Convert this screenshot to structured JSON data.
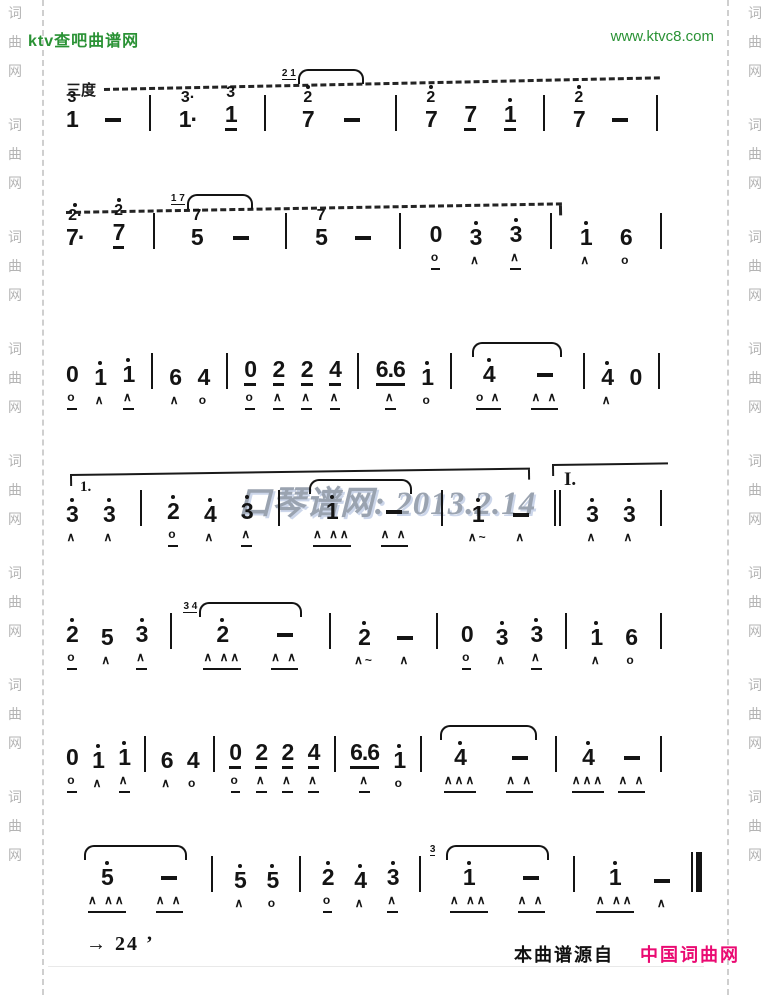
{
  "header": {
    "site": "ktv查吧曲谱网",
    "url": "www.ktvc8.com",
    "green": "#2a9235"
  },
  "margins": {
    "text": "词曲网"
  },
  "score": {
    "interval_label": "三度",
    "volta_left": "1.",
    "volta_right": "I.",
    "watermark": "口琴谱网: 2013.2.14",
    "ink": "#141414",
    "systems": [
      {
        "tokens": [
          {
            "k": "n",
            "t": "1",
            "top": "3"
          },
          {
            "k": "d"
          },
          {
            "k": "b"
          },
          {
            "k": "n",
            "t": "1",
            "top": "3",
            "dt": true
          },
          {
            "k": "n",
            "t": "1",
            "top": "3",
            "ul": 1
          },
          {
            "k": "b"
          },
          {
            "k": "tie",
            "items": [
              {
                "k": "n",
                "t": "7",
                "top": "2",
                "toph": 1,
                "gr": "2 1"
              },
              {
                "k": "d"
              }
            ]
          },
          {
            "k": "b"
          },
          {
            "k": "n",
            "t": "7",
            "top": "2",
            "toph": 1
          },
          {
            "k": "n",
            "t": "7",
            "ul": 1
          },
          {
            "k": "n",
            "t": "1",
            "hd": 1,
            "ul": 1
          },
          {
            "k": "b"
          },
          {
            "k": "n",
            "t": "7",
            "top": "2",
            "toph": 1
          },
          {
            "k": "d"
          },
          {
            "k": "b"
          }
        ]
      },
      {
        "tokens": [
          {
            "k": "n",
            "t": "7",
            "top": "2",
            "toph": 1,
            "dt": true
          },
          {
            "k": "n",
            "t": "7",
            "top": "2",
            "toph": 1,
            "ul": 1
          },
          {
            "k": "b"
          },
          {
            "k": "tie",
            "items": [
              {
                "k": "n",
                "t": "5",
                "top": "7",
                "gr": "1 7"
              },
              {
                "k": "d"
              }
            ]
          },
          {
            "k": "b"
          },
          {
            "k": "n",
            "t": "5",
            "top": "7"
          },
          {
            "k": "d"
          },
          {
            "k": "b"
          },
          {
            "k": "n",
            "t": "0",
            "u": "o",
            "uml": true
          },
          {
            "k": "n",
            "t": "3",
            "hd": 1,
            "u": "∧"
          },
          {
            "k": "n",
            "t": "3",
            "hd": 1,
            "u": "∧",
            "uml": true
          },
          {
            "k": "b"
          },
          {
            "k": "n",
            "t": "1",
            "hd": 1,
            "u": "∧"
          },
          {
            "k": "n",
            "t": "6",
            "u": "o"
          },
          {
            "k": "b"
          }
        ]
      },
      {
        "tokens": [
          {
            "k": "n",
            "t": "0",
            "u": "o",
            "uml": true
          },
          {
            "k": "n",
            "t": "1",
            "hd": 1,
            "u": "∧"
          },
          {
            "k": "n",
            "t": "1",
            "hd": 1,
            "u": "∧",
            "uml": true
          },
          {
            "k": "b"
          },
          {
            "k": "n",
            "t": "6",
            "u": "∧"
          },
          {
            "k": "n",
            "t": "4",
            "u": "o"
          },
          {
            "k": "b"
          },
          {
            "k": "n",
            "t": "0",
            "ul": 1,
            "u": "o",
            "uml": true
          },
          {
            "k": "n",
            "t": "2",
            "ul": 1,
            "u": "∧",
            "uml": true
          },
          {
            "k": "n",
            "t": "2",
            "ul": 1,
            "u": "∧",
            "uml": true
          },
          {
            "k": "n",
            "t": "4",
            "ul": 1,
            "u": "∧",
            "uml": true
          },
          {
            "k": "b"
          },
          {
            "k": "n",
            "t": "6.6",
            "ul": 1,
            "u": "∧",
            "uml": true
          },
          {
            "k": "n",
            "t": "1",
            "hd": 1,
            "u": "o"
          },
          {
            "k": "b"
          },
          {
            "k": "tie",
            "items": [
              {
                "k": "n",
                "t": "4",
                "hd": 1,
                "u": "o ∧",
                "uml": true
              },
              {
                "k": "d",
                "u": "∧ ∧",
                "uml": true
              }
            ]
          },
          {
            "k": "b"
          },
          {
            "k": "n",
            "t": "4",
            "hd": 1,
            "u": "∧"
          },
          {
            "k": "n",
            "t": "0"
          },
          {
            "k": "b"
          }
        ]
      },
      {
        "tokens": [
          {
            "k": "n",
            "t": "3",
            "hd": 1,
            "u": "∧"
          },
          {
            "k": "n",
            "t": "3",
            "hd": 1,
            "u": "∧"
          },
          {
            "k": "b"
          },
          {
            "k": "n",
            "t": "2",
            "hd": 1,
            "u": "o",
            "uml": true
          },
          {
            "k": "n",
            "t": "4",
            "hd": 1,
            "u": "∧"
          },
          {
            "k": "n",
            "t": "3",
            "hd": 1,
            "u": "∧",
            "uml": true
          },
          {
            "k": "b"
          },
          {
            "k": "tie",
            "items": [
              {
                "k": "n",
                "t": "1",
                "hd": 1,
                "u": "∧ ∧∧",
                "uml": true
              },
              {
                "k": "d",
                "u": "∧ ∧",
                "uml": true
              }
            ]
          },
          {
            "k": "b"
          },
          {
            "k": "n",
            "t": "1",
            "hd": 1,
            "u": "∧~"
          },
          {
            "k": "d",
            "u": "∧"
          },
          {
            "k": "b2"
          },
          {
            "k": "n",
            "t": "3",
            "hd": 1,
            "u": "∧"
          },
          {
            "k": "n",
            "t": "3",
            "hd": 1,
            "u": "∧"
          },
          {
            "k": "b"
          }
        ]
      },
      {
        "tokens": [
          {
            "k": "n",
            "t": "2",
            "hd": 1,
            "u": "o",
            "uml": true
          },
          {
            "k": "n",
            "t": "5",
            "u": "∧"
          },
          {
            "k": "n",
            "t": "3",
            "hd": 1,
            "u": "∧",
            "uml": true
          },
          {
            "k": "b"
          },
          {
            "k": "tie",
            "items": [
              {
                "k": "n",
                "t": "2",
                "hd": 1,
                "gr": "3 4",
                "u": "∧ ∧∧",
                "uml": true
              },
              {
                "k": "d",
                "u": "∧ ∧",
                "uml": true
              }
            ]
          },
          {
            "k": "b"
          },
          {
            "k": "n",
            "t": "2",
            "hd": 1,
            "u": "∧~"
          },
          {
            "k": "d",
            "u": "∧"
          },
          {
            "k": "b"
          },
          {
            "k": "n",
            "t": "0",
            "u": "o",
            "uml": true
          },
          {
            "k": "n",
            "t": "3",
            "hd": 1,
            "u": "∧"
          },
          {
            "k": "n",
            "t": "3",
            "hd": 1,
            "u": "∧",
            "uml": true
          },
          {
            "k": "b"
          },
          {
            "k": "n",
            "t": "1",
            "hd": 1,
            "u": "∧"
          },
          {
            "k": "n",
            "t": "6",
            "u": "o"
          },
          {
            "k": "b"
          }
        ]
      },
      {
        "tokens": [
          {
            "k": "n",
            "t": "0",
            "u": "o",
            "uml": true
          },
          {
            "k": "n",
            "t": "1",
            "hd": 1,
            "u": "∧"
          },
          {
            "k": "n",
            "t": "1",
            "hd": 1,
            "u": "∧",
            "uml": true
          },
          {
            "k": "b"
          },
          {
            "k": "n",
            "t": "6",
            "u": "∧"
          },
          {
            "k": "n",
            "t": "4",
            "u": "o"
          },
          {
            "k": "b"
          },
          {
            "k": "n",
            "t": "0",
            "ul": 1,
            "u": "o",
            "uml": true
          },
          {
            "k": "n",
            "t": "2",
            "ul": 1,
            "u": "∧",
            "uml": true
          },
          {
            "k": "n",
            "t": "2",
            "ul": 1,
            "u": "∧",
            "uml": true
          },
          {
            "k": "n",
            "t": "4",
            "ul": 1,
            "u": "∧",
            "uml": true
          },
          {
            "k": "b"
          },
          {
            "k": "n",
            "t": "6.6",
            "ul": 1,
            "u": "∧",
            "uml": true
          },
          {
            "k": "n",
            "t": "1",
            "hd": 1,
            "u": "o"
          },
          {
            "k": "b"
          },
          {
            "k": "tie",
            "items": [
              {
                "k": "n",
                "t": "4",
                "hd": 1,
                "u": "∧∧∧",
                "uml": true
              },
              {
                "k": "d",
                "u": "∧ ∧",
                "uml": true
              }
            ]
          },
          {
            "k": "b"
          },
          {
            "k": "n",
            "t": "4",
            "hd": 1,
            "u": "∧∧∧",
            "uml": true
          },
          {
            "k": "d",
            "u": "∧ ∧",
            "uml": true
          },
          {
            "k": "b"
          }
        ]
      },
      {
        "tokens": [
          {
            "k": "tie",
            "items": [
              {
                "k": "n",
                "t": "5",
                "hd": 1,
                "u": "∧ ∧∧",
                "uml": true
              },
              {
                "k": "d",
                "u": "∧ ∧",
                "uml": true
              }
            ]
          },
          {
            "k": "b"
          },
          {
            "k": "n",
            "t": "5",
            "hd": 1,
            "u": "∧"
          },
          {
            "k": "n",
            "t": "5",
            "hd": 1,
            "u": "o"
          },
          {
            "k": "b"
          },
          {
            "k": "n",
            "t": "2",
            "hd": 1,
            "u": "o",
            "uml": true
          },
          {
            "k": "n",
            "t": "4",
            "hd": 1,
            "u": "∧"
          },
          {
            "k": "n",
            "t": "3",
            "hd": 1,
            "u": "∧",
            "uml": true
          },
          {
            "k": "b"
          },
          {
            "k": "tie",
            "items": [
              {
                "k": "n",
                "t": "1",
                "hd": 1,
                "gr": "3",
                "u": "∧ ∧∧",
                "uml": true
              },
              {
                "k": "d",
                "u": "∧ ∧",
                "uml": true
              }
            ]
          },
          {
            "k": "b"
          },
          {
            "k": "n",
            "t": "1",
            "hd": 1,
            "u": "∧ ∧∧",
            "uml": true
          },
          {
            "k": "d",
            "u": "∧"
          },
          {
            "k": "bf"
          }
        ]
      }
    ]
  },
  "footer": {
    "page_label": "→ 24 ʼ",
    "source_prefix": "本曲谱源自",
    "source_name": "中国词曲网",
    "accent": "#ea0a72"
  }
}
